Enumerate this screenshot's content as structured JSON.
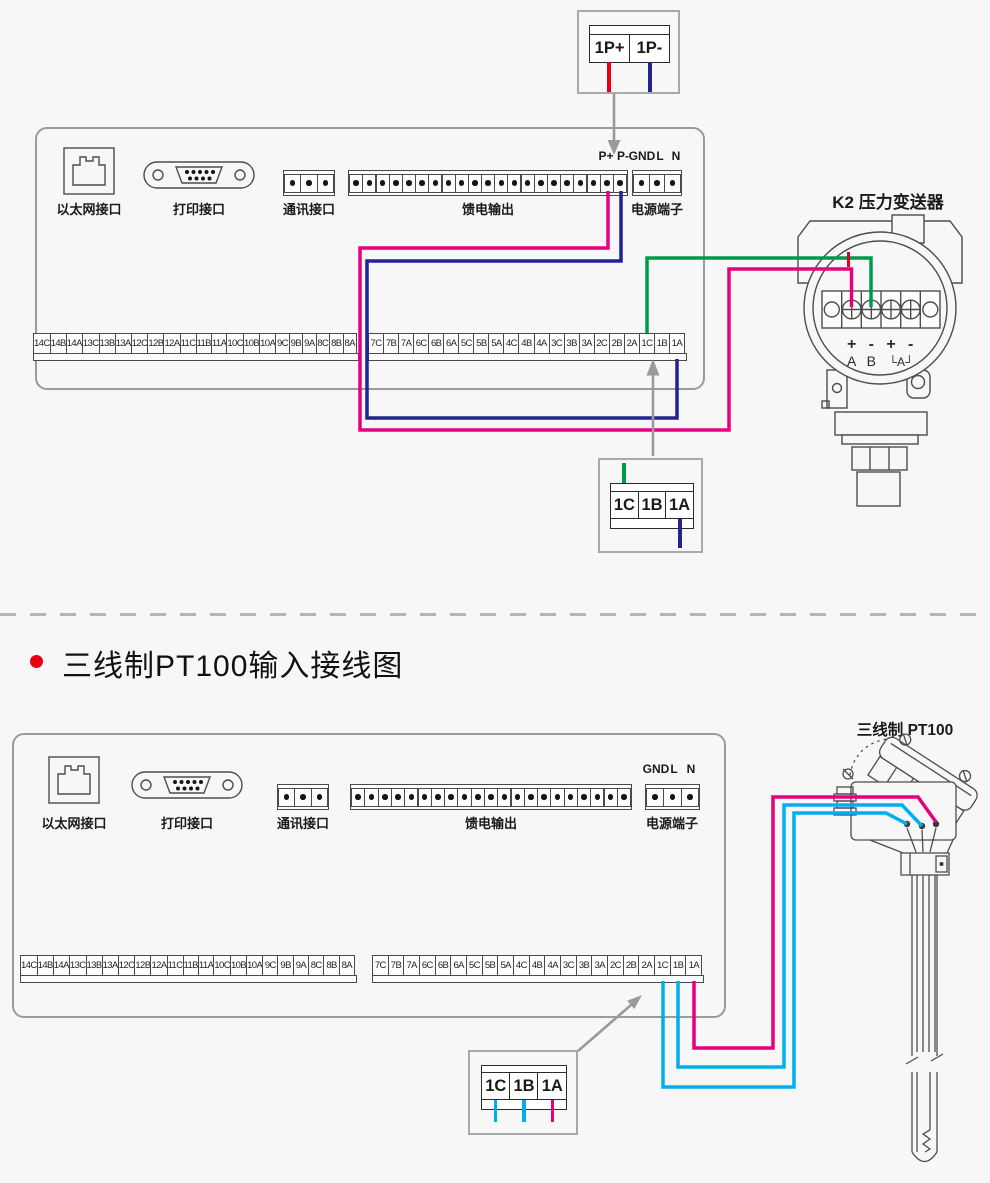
{
  "colors": {
    "magenta": "#e5007d",
    "navy": "#23238f",
    "green": "#009a4e",
    "cyan": "#00aeef",
    "red": "#e60012",
    "arrow_gray": "#9a9a9a",
    "outline": "#4f4c4c",
    "panel_border": "#9b9b9b"
  },
  "section_title": {
    "text": "三线制PT100输入接线图"
  },
  "top_diagram": {
    "callout_cells": [
      "1P+",
      "1P-"
    ],
    "mid_callout_cells": [
      "1C",
      "1B",
      "1A"
    ],
    "panel": {
      "ethernet_label": "以太网接口",
      "printer_label": "打印接口",
      "comm_label": "通讯接口",
      "feed_label": "馈电输出",
      "power_label": "电源端子",
      "terminal_marks": [
        "P+",
        "P-",
        "GND",
        "L",
        "N"
      ],
      "comm_terminal_count": 3,
      "feed_terminal_count": 21,
      "power_terminal_count": 3,
      "left_terminals": [
        "14C",
        "14B",
        "14A",
        "13C",
        "13B",
        "13A",
        "12C",
        "12B",
        "12A",
        "11C",
        "11B",
        "11A",
        "10C",
        "10B",
        "10A",
        "9C",
        "9B",
        "9A",
        "8C",
        "8B",
        "8A"
      ],
      "right_terminals": [
        "7C",
        "7B",
        "7A",
        "6C",
        "6B",
        "6A",
        "5C",
        "5B",
        "5A",
        "4C",
        "4B",
        "4A",
        "3C",
        "3B",
        "3A",
        "2C",
        "2B",
        "2A",
        "1C",
        "1B",
        "1A"
      ]
    },
    "transmitter": {
      "label": "K2  压力变送器",
      "signs": [
        "+",
        "-",
        "+",
        "-"
      ],
      "names": [
        "A",
        "B",
        "└A┘"
      ]
    }
  },
  "bottom_diagram": {
    "callout_cells": [
      "1C",
      "1B",
      "1A"
    ],
    "sensor": {
      "label": "三线制  PT100"
    },
    "panel": {
      "ethernet_label": "以太网接口",
      "printer_label": "打印接口",
      "comm_label": "通讯接口",
      "feed_label": "馈电输出",
      "power_label": "电源端子",
      "terminal_marks": [
        "GND",
        "L",
        "N"
      ],
      "comm_terminal_count": 3,
      "feed_terminal_count": 21,
      "power_terminal_count": 3,
      "left_terminals": [
        "14C",
        "14B",
        "14A",
        "13C",
        "13B",
        "13A",
        "12C",
        "12B",
        "12A",
        "11C",
        "11B",
        "11A",
        "10C",
        "10B",
        "10A",
        "9C",
        "9B",
        "9A",
        "8C",
        "8B",
        "8A"
      ],
      "right_terminals": [
        "7C",
        "7B",
        "7A",
        "6C",
        "6B",
        "6A",
        "5C",
        "5B",
        "5A",
        "4C",
        "4B",
        "4A",
        "3C",
        "3B",
        "3A",
        "2C",
        "2B",
        "2A",
        "1C",
        "1B",
        "1A"
      ]
    }
  }
}
